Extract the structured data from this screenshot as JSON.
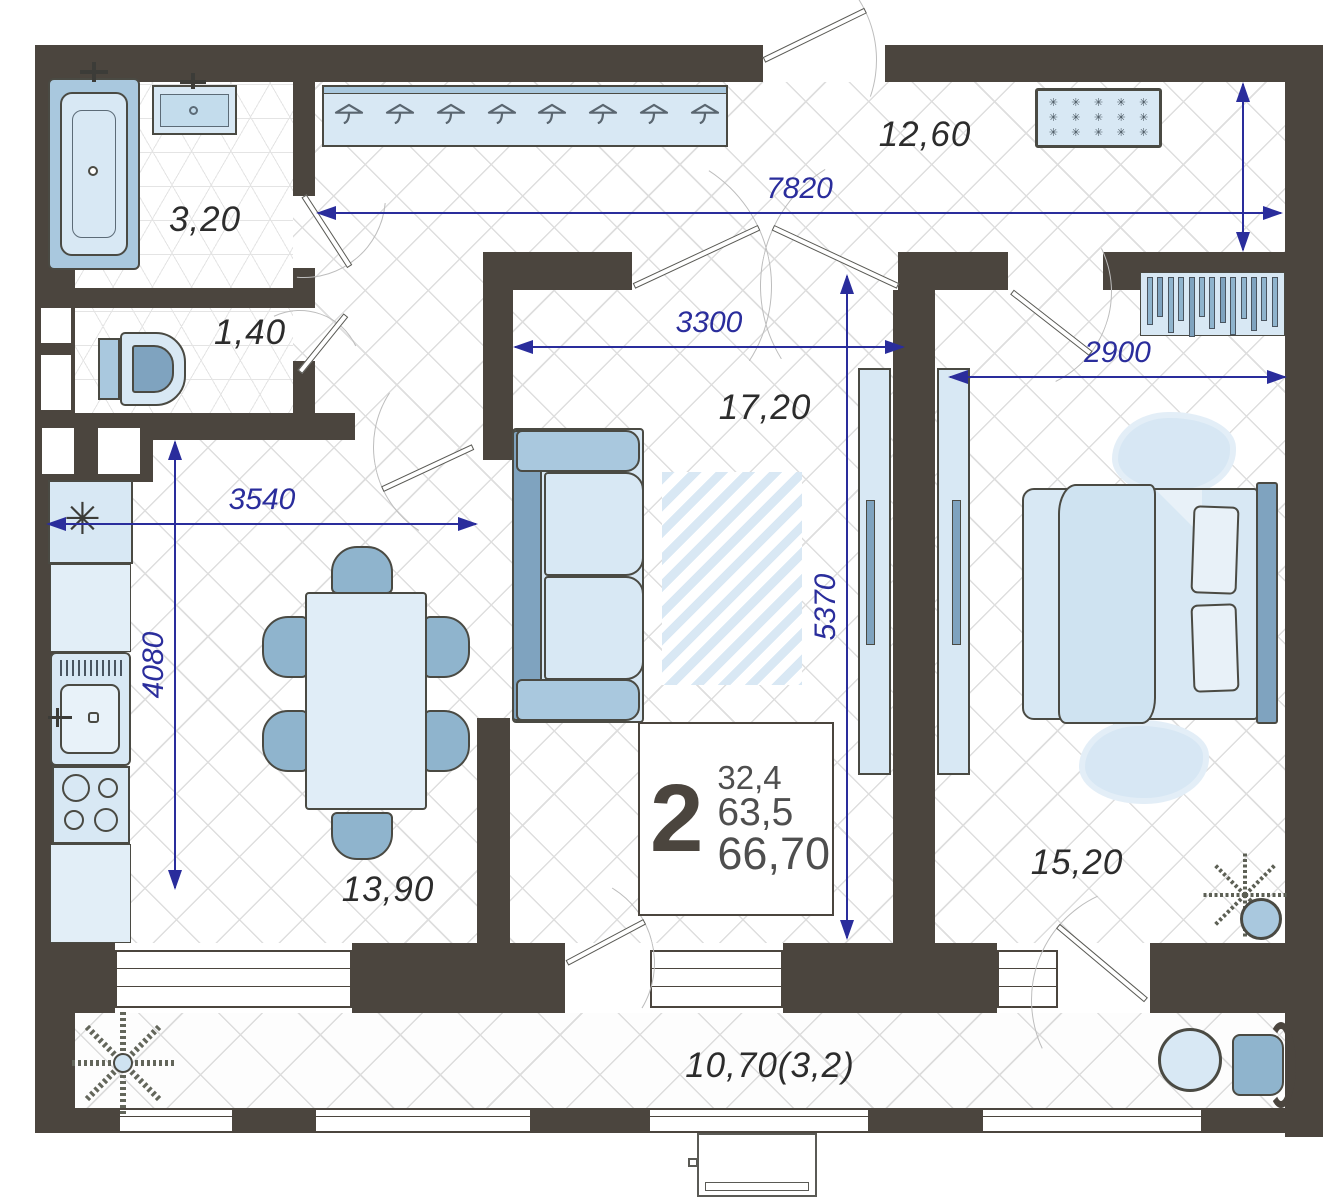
{
  "meta": {
    "type": "apartment floor plan"
  },
  "colors": {
    "wall": "#4b453e",
    "dimension": "#2a2d9c",
    "room_label": "#2c2c2c",
    "furniture_light": "#d8e8f4",
    "furniture_mid": "#a9c8de",
    "furniture_dark": "#7fa3bf"
  },
  "info_box": {
    "room_count": "2",
    "areas": [
      "32,4",
      "63,5",
      "66,70"
    ]
  },
  "rooms": {
    "bathroom": {
      "label": "3,20"
    },
    "wc": {
      "label": "1,40"
    },
    "hallway": {
      "label": "12,60"
    },
    "living": {
      "label": "17,20"
    },
    "kitchen": {
      "label": "13,90"
    },
    "bedroom": {
      "label": "15,20"
    },
    "balcony": {
      "label": "10,70(3,2)"
    }
  },
  "dimensions_mm": {
    "hallway_width": "7820",
    "living_width": "3300",
    "bedroom_width": "2900",
    "kitchen_width": "3540",
    "kitchen_depth": "4080",
    "living_depth": "5370"
  },
  "symbols": {
    "fridge_mark": "✳"
  },
  "decor": {
    "hanger_count": 8,
    "doormat_dots": 15,
    "slat_count": 13
  }
}
